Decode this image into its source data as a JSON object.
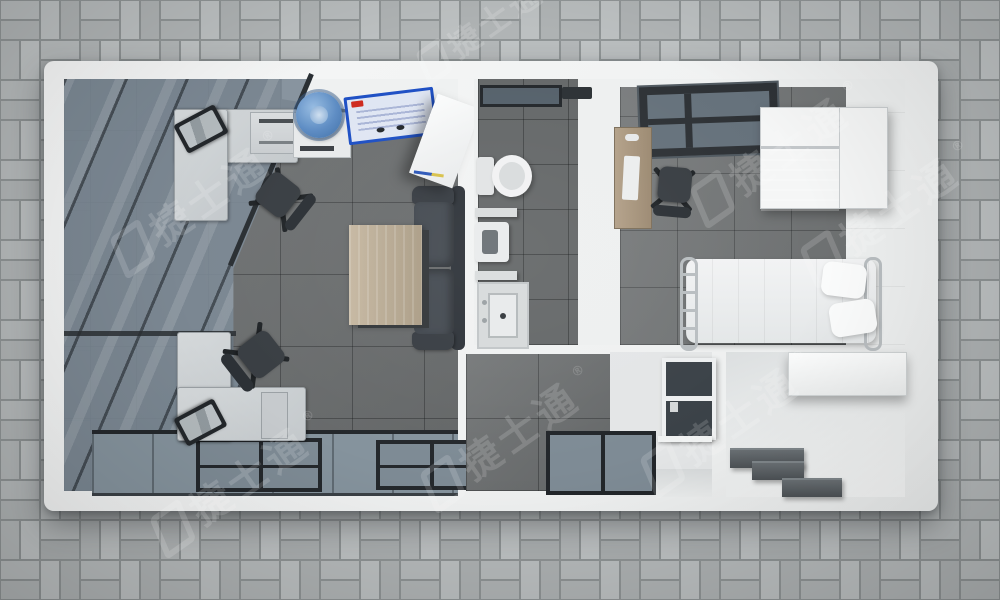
{
  "scene": {
    "description": "Top-down 3D render of a modular container house floor plan on grey basket-weave paver ground",
    "watermark": {
      "text": "捷士通",
      "registered": "®"
    },
    "ground": {
      "material": "grey basket-weave pavers",
      "paver_color": "#b7bbbc",
      "grout_color": "#8f9495"
    },
    "building": {
      "roof_border_color": "#f3f4f4",
      "frame_dark_color": "#24282c",
      "glass_color": "#7c8a96"
    },
    "rooms": [
      {
        "name": "office",
        "floor_color": "#6e7172",
        "items": [
          "glass roof panels with dark mullions",
          "corner workstation with monitor (x2)",
          "office chair (x2)",
          "storage counter",
          "water dispenser with blue bottle",
          "blue notice board",
          "white cabinet",
          "dark grey two-seat sofa",
          "wooden coffee table",
          "full-width window wall"
        ]
      },
      {
        "name": "bathroom",
        "floor_color": "#656869",
        "items": [
          "top window",
          "vent",
          "toilet",
          "wall shelf (x2)",
          "wall-hung urinal",
          "vanity sink"
        ]
      },
      {
        "name": "bedroom",
        "floor_color": "#747778",
        "items": [
          "skylight",
          "wooden desk",
          "office chair",
          "white wardrobe cabinet",
          "single bed with two pillows"
        ]
      },
      {
        "name": "utility room",
        "floor_color": "#e4e6e7",
        "items": [
          "interior window",
          "grey tiled wall"
        ]
      },
      {
        "name": "kitchen",
        "floor_color": "#eef0f0",
        "items": [
          "overhead cabinet",
          "stepped dark counters",
          "grey tiled wall"
        ]
      }
    ]
  }
}
